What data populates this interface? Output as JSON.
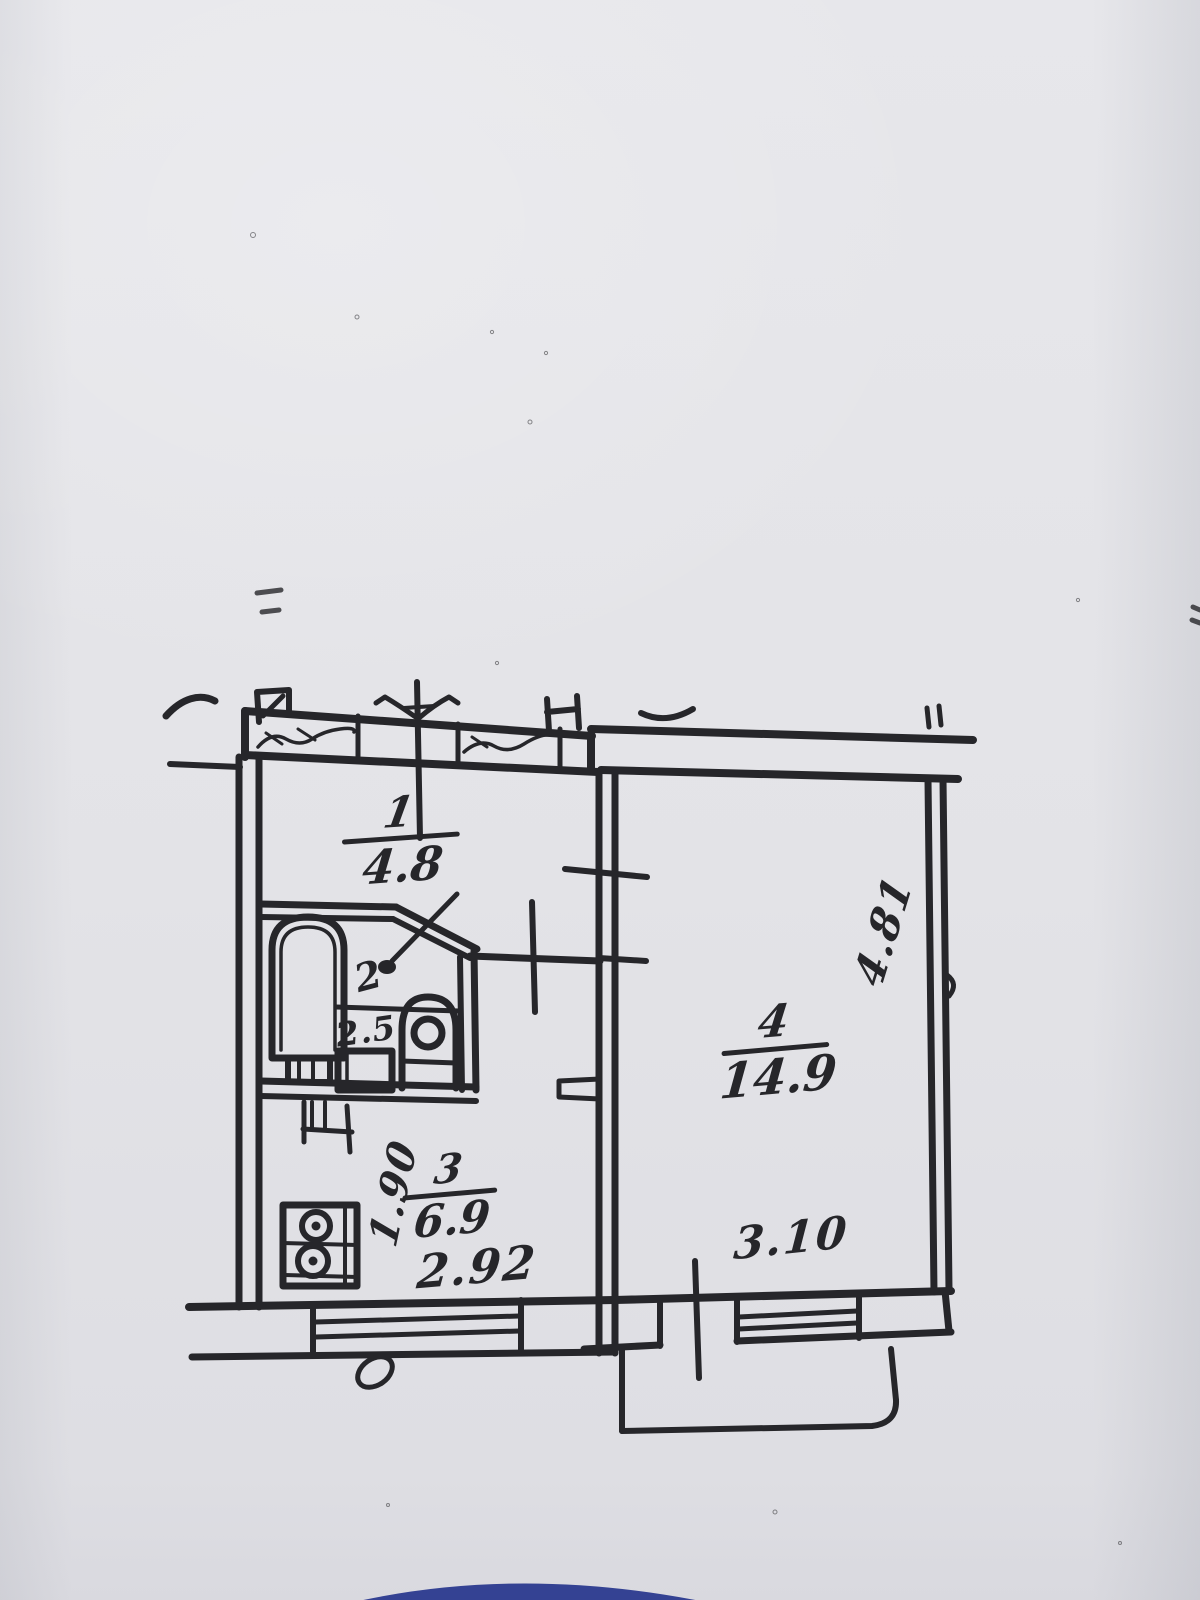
{
  "photo": {
    "description": "scanned hand-drawn apartment floor plan on gray paper",
    "paper_color": "#e4e4e8",
    "ink_color": "#26262a",
    "stamp_color": "#2c3a8f"
  },
  "rooms": [
    {
      "number": "1",
      "area": "4.8"
    },
    {
      "number": "2",
      "area": "2.5"
    },
    {
      "number": "3",
      "area": "6.9"
    },
    {
      "number": "4",
      "area": "14.9"
    }
  ],
  "dimensions": {
    "kitchen_width": "2.92",
    "kitchen_depth": "1.90",
    "room4_width": "3.10",
    "room4_depth": "4.81"
  },
  "fixtures": [
    "bathtub-icon",
    "sink-icon",
    "toilet-icon",
    "stove-icon",
    "vent-stack-icon",
    "chimney-tab-icon",
    "balcony",
    "kitchen-window",
    "room4-window",
    "blue-stamp-arc"
  ]
}
